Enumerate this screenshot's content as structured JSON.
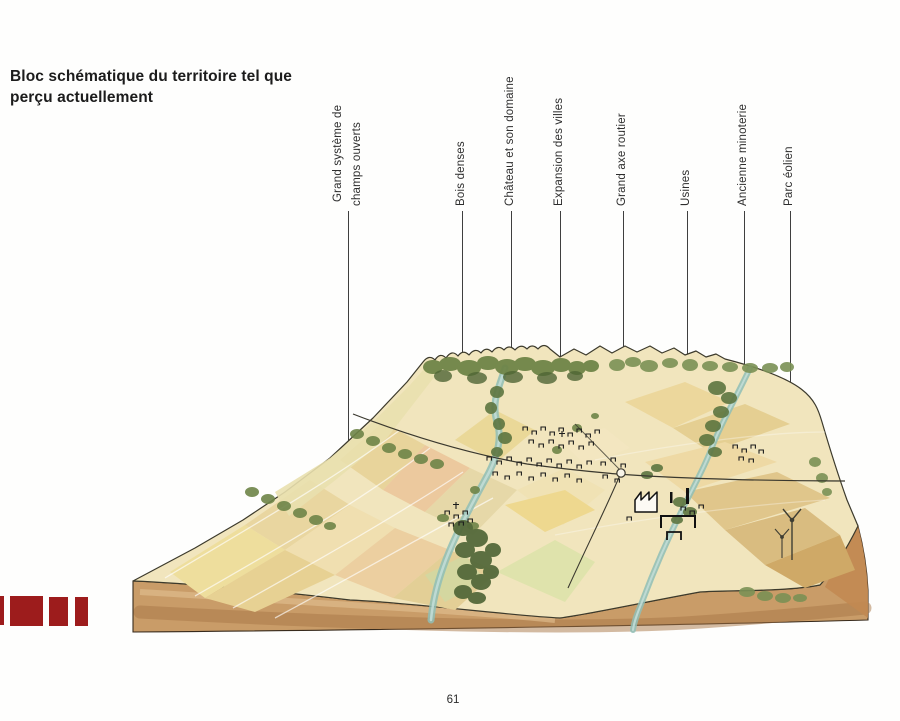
{
  "title": {
    "line1": "Bloc schématique du territoire tel que",
    "line2": "perçu actuellement"
  },
  "annotations": [
    {
      "label": "Grand système de",
      "label2": "champs ouverts"
    },
    {
      "label": "Bois denses"
    },
    {
      "label": "Château et son domaine"
    },
    {
      "label": "Expansion des villes"
    },
    {
      "label": "Grand axe routier"
    },
    {
      "label": "Usines"
    },
    {
      "label": "Ancienne minoterie"
    },
    {
      "label": "Parc éolien"
    }
  ],
  "page_number": "61",
  "colors": {
    "accent_red": "#9d1c1c",
    "soil_brown": "#c99c68",
    "field_yellow": "#f0e4bc",
    "woods_green": "#6e8447",
    "river_blue": "#8fbeb6"
  }
}
